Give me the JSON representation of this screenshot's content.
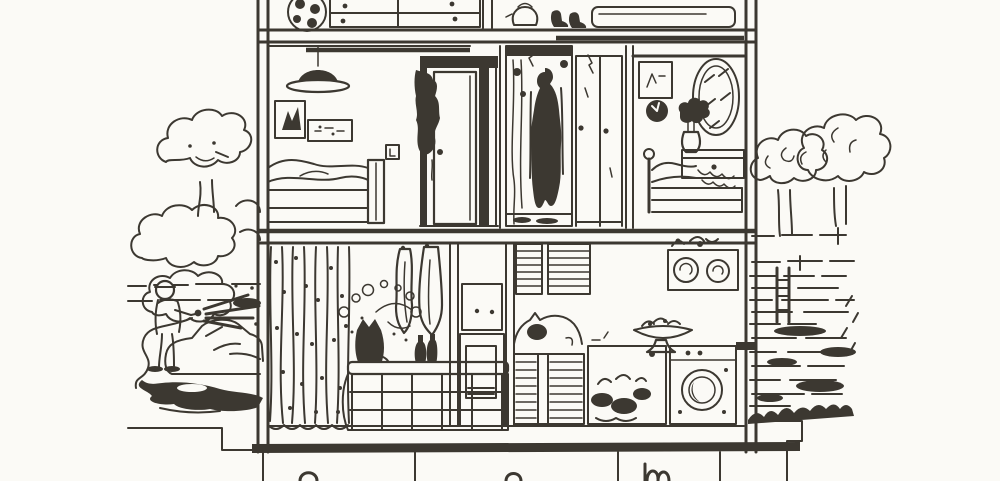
{
  "meta": {
    "description": "Scanned black-and-white line drawing: cutaway cross-section of a two-storey house with attic and basement. Outside on the left a person hoses down a car beside bushes and a tree; outside on the right are trees, fence rails and scribbled ground.",
    "style": "pen-and-ink textbook illustration, no text visible"
  },
  "colors": {
    "ink": "#3c3831",
    "paper": "#fbfaf6"
  },
  "scene": {
    "house": {
      "attic": {
        "objects": [
          "football",
          "chest-of-drawers-with-knobs",
          "kettle",
          "pair-of-boots",
          "long-storage-chest"
        ]
      },
      "second_floor": {
        "bedroom_left": {
          "objects": [
            "pendant-lamp",
            "picture-frame-tall",
            "picture-frame-wide",
            "light-switch",
            "double-bed-with-pillows",
            "open-door-with-hanging-robe"
          ]
        },
        "shower_room": {
          "objects": [
            "shower-stall",
            "wet-person-behind-curtain",
            "sliding-glass-panels"
          ]
        },
        "bedroom_right": {
          "objects": [
            "dark-framed-picture",
            "round-wall-clock",
            "oval-mirror",
            "vase-of-flowers",
            "dresser-with-drawer",
            "bed-with-ball-post"
          ]
        }
      },
      "first_floor": {
        "bathroom": {
          "objects": [
            "polka-dot-curtains",
            "hanging-towels",
            "soap-bubbles",
            "cat-on-tub-rim",
            "shampoo-bottles",
            "tiled-bathtub",
            "cupboard-and-door"
          ]
        },
        "kitchen": {
          "objects": [
            "slatted-blinds",
            "shelf-with-pots",
            "sleeping-cat-on-counter",
            "fruit-bowl-on-stand",
            "slatted-cabinet",
            "sink-unit-with-mess",
            "washing-machine"
          ]
        }
      },
      "basement": {
        "objects": [
          "foundation-band",
          "partition-walls",
          "partially-cropped-shapes"
        ]
      }
    },
    "outside_left": {
      "objects": [
        "small-tree",
        "bushes",
        "hedge-lines",
        "person-with-hose",
        "water-spray",
        "garden-hose-loop",
        "car",
        "dark-puddle",
        "doorstep"
      ]
    },
    "outside_right": {
      "objects": [
        "two-trees",
        "fence-rails",
        "dark-fence-post",
        "scribbled-grass-ground"
      ]
    }
  }
}
